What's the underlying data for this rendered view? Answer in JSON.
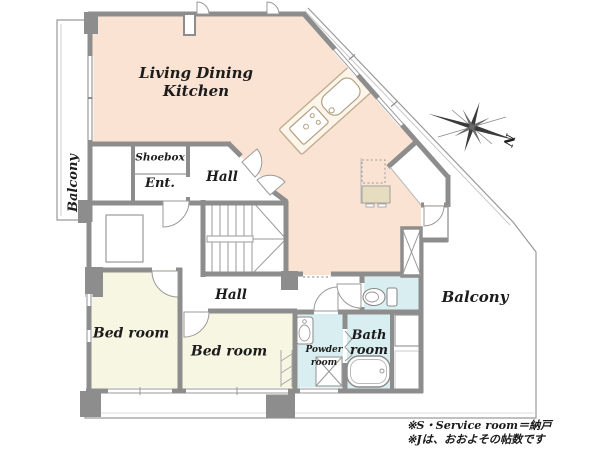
{
  "plan": {
    "title": "apartment-floor-plan",
    "rooms": {
      "ldk": {
        "label_line1": "Living Dining",
        "label_line2": "Kitchen"
      },
      "balcony_left": {
        "label": "Balcony"
      },
      "balcony_right": {
        "label": "Balcony"
      },
      "shoebox": {
        "label": "Shoebox"
      },
      "entrance": {
        "label": "Ent."
      },
      "hall_upper": {
        "label": "Hall"
      },
      "hall_lower": {
        "label": "Hall"
      },
      "bedroom_1": {
        "label": "Bed room"
      },
      "bedroom_2": {
        "label": "Bed room"
      },
      "powder_room": {
        "label_line1": "Powder",
        "label_line2": "room"
      },
      "bath_room": {
        "label_line1": "Bath",
        "label_line2": "room"
      }
    },
    "compass": {
      "north_label": "N"
    },
    "notes": {
      "line1": "※S・Service room＝納戸",
      "line2": "※Jは、おおよその帖数です"
    },
    "colors": {
      "ldk_fill": "#fae3d2",
      "bedroom_fill": "#f7f6e3",
      "wet_area_fill": "#d9eef0",
      "wall_gray": "#8d8d8d",
      "thin_line_gray": "#9a9a9a",
      "counter_beige": "#e6dcc0"
    }
  }
}
